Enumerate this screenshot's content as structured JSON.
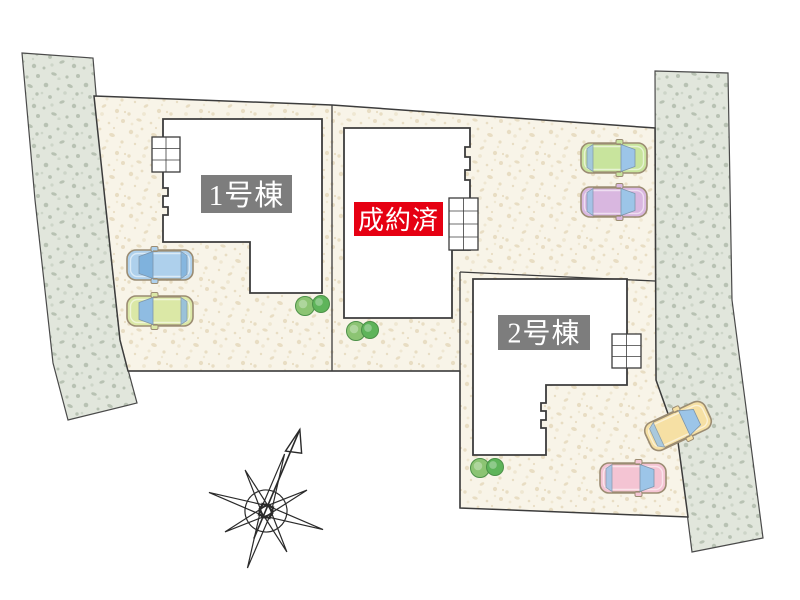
{
  "site_plan": {
    "units": [
      {
        "name": "unit-1",
        "label": "1号棟",
        "status": "available",
        "label_bg": "#7d7d7d",
        "label_text_color": "#ffffff"
      },
      {
        "name": "unit-center",
        "label": "成約済",
        "status": "sold",
        "label_bg": "#e60012",
        "label_text_color": "#ffffff"
      },
      {
        "name": "unit-2",
        "label": "2号棟",
        "status": "available",
        "label_bg": "#7d7d7d",
        "label_text_color": "#ffffff"
      }
    ],
    "icons": {
      "compass": "compass-rose-north-arrow"
    },
    "colors": {
      "lot_fill": "#f8f4e8",
      "lot_speckle": "#e8ddc3",
      "road_fill": "#e1e6dc",
      "road_speckle": "#b8c2b3",
      "outline": "#3c3c3c",
      "building_fill": "#ffffff",
      "sold_red": "#e60012",
      "label_gray": "#7d7d7d"
    },
    "cars": [
      {
        "name": "car-blue",
        "body": "#aed0ec",
        "glass": "#7fb2dd",
        "x": 160,
        "y": 265,
        "rotation": 180
      },
      {
        "name": "car-lime",
        "body": "#dbe8a6",
        "glass": "#8fbce2",
        "x": 160,
        "y": 311,
        "rotation": 180
      },
      {
        "name": "car-green",
        "body": "#c8e49d",
        "glass": "#9cc5e8",
        "x": 614,
        "y": 158,
        "rotation": 0
      },
      {
        "name": "car-purple",
        "body": "#d9b7e0",
        "glass": "#9cc5e8",
        "x": 614,
        "y": 202,
        "rotation": 0
      },
      {
        "name": "car-yellow",
        "body": "#f6e0a4",
        "glass": "#9cc5e8",
        "x": 678,
        "y": 426,
        "rotation": -25
      },
      {
        "name": "car-pink",
        "body": "#f4c4d3",
        "glass": "#9cc5e8",
        "x": 633,
        "y": 478,
        "rotation": 0
      }
    ],
    "trees": [
      {
        "x": 305,
        "y": 306,
        "r": 9.5,
        "fill": "#8cc473"
      },
      {
        "x": 321,
        "y": 304,
        "r": 8.5,
        "fill": "#5eb45a"
      },
      {
        "x": 356,
        "y": 331,
        "r": 9.5,
        "fill": "#8cc473"
      },
      {
        "x": 370,
        "y": 330,
        "r": 8.5,
        "fill": "#5eb45a"
      },
      {
        "x": 480,
        "y": 468,
        "r": 9.5,
        "fill": "#8cc473"
      },
      {
        "x": 495,
        "y": 467,
        "r": 8.5,
        "fill": "#5eb45a"
      }
    ]
  }
}
